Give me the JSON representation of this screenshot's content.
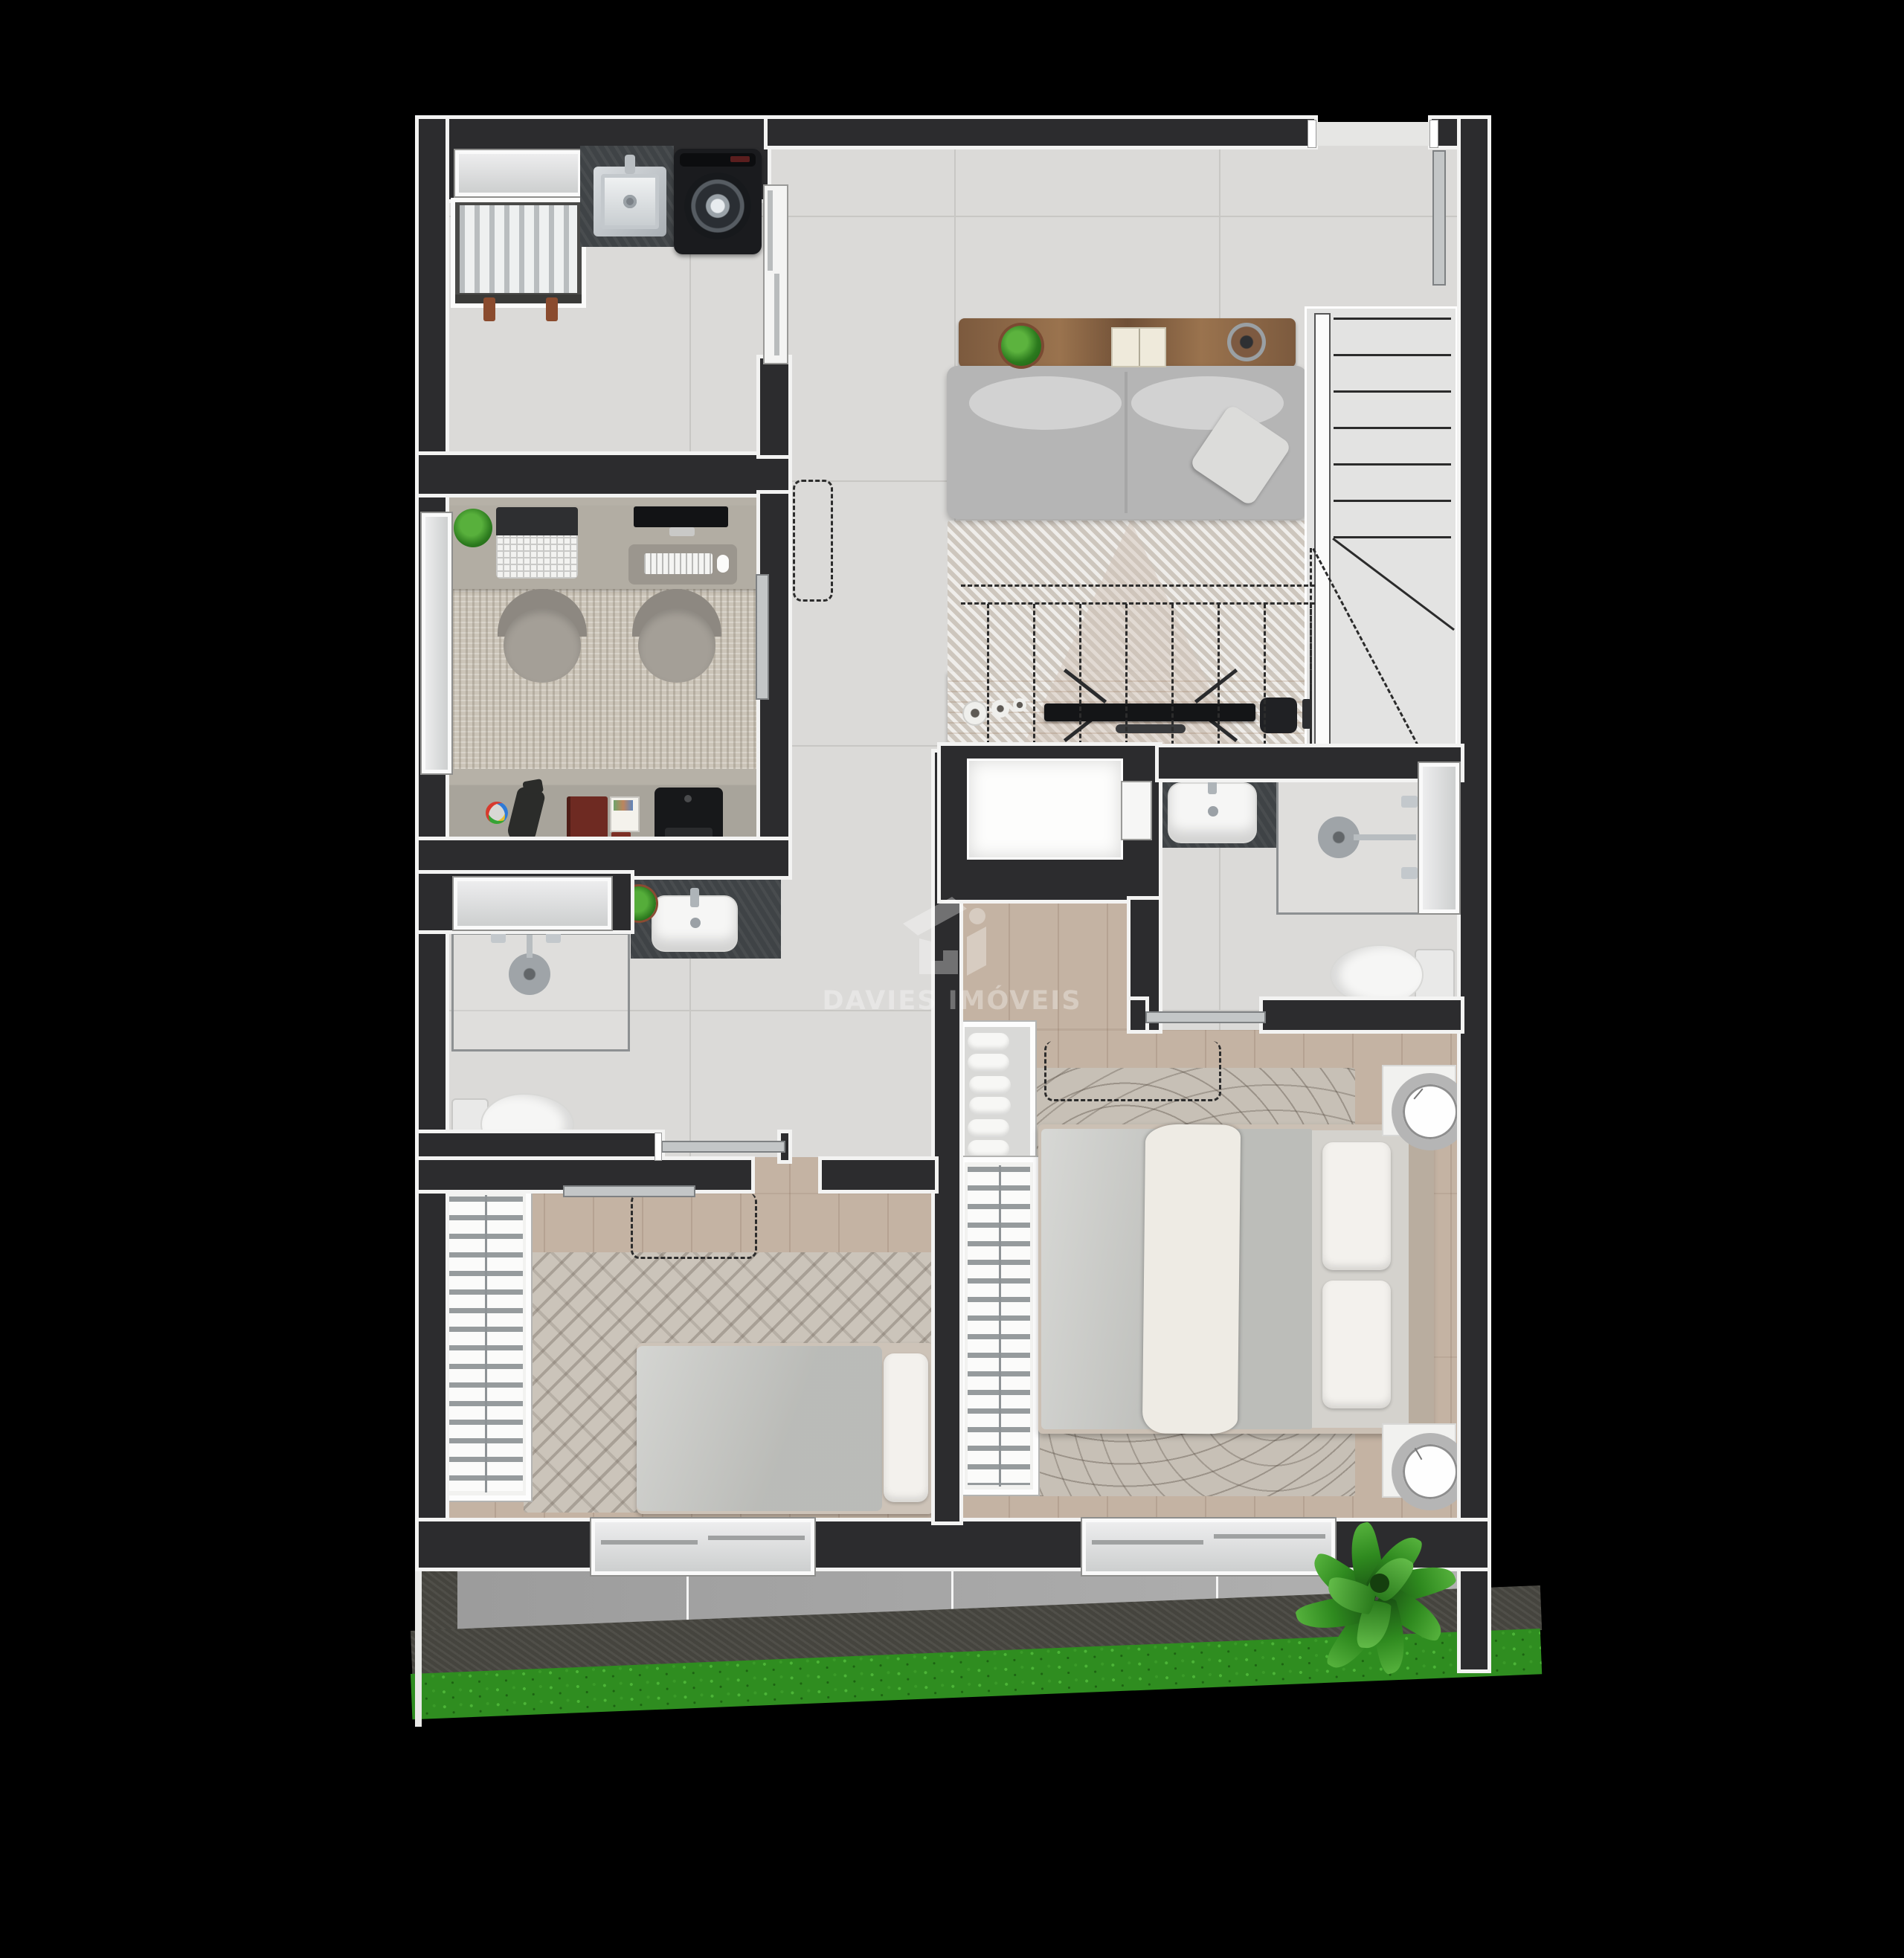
{
  "watermark": {
    "brand": "DAVIES IMÓVEIS",
    "logo": "davies-house-monogram"
  },
  "colors": {
    "bg": "#000000",
    "wall": "#2c2c2e",
    "outline": "#f3f3f2",
    "tile": "#dbdad8",
    "tileLine": "#c8c7c4",
    "wood": "#c4b3a3",
    "office": "#b6b1a7",
    "terrace": "#a8a8a8",
    "grout": "#f5f5f5",
    "slate": "#45443e",
    "hedge": "#2f8d20",
    "counter": "#3f4346",
    "glass": "#8d9092",
    "dash": "#2c2c2c",
    "fixture": "#f6f6f5",
    "consoleWood": "#8a6647",
    "tvWood": "#bf8f66",
    "sofa": "#b5b5b5",
    "cushion": "#d2d2d2",
    "rugLiving": "#d8d2ca",
    "rugOffice": "#ccc5b9",
    "rugWavy": "#c7c0b6",
    "rugChevron": "#cbc4ba",
    "duvet": "#c6c7c3",
    "sheet": "#d4d2cd",
    "pillow": "#f3f1ed",
    "throw": "#eeebe4",
    "headboard": "#b9ad9f",
    "washer": "#1a1b1e",
    "green": "#3f9b2e",
    "greenDark": "#1e5c17",
    "watermark": "rgba(255,255,255,0.33)"
  },
  "plan": {
    "type": "residential-floor-plan-render",
    "rooms": [
      {
        "name": "laundry",
        "items": [
          "frosted-window",
          "condenser-niche",
          "utility-sink",
          "washing-machine",
          "sliding-partition"
        ]
      },
      {
        "name": "living-room",
        "items": [
          "console-table",
          "plant-pot",
          "open-book",
          "table-lamp",
          "sofa",
          "throw-pillow",
          "striped-rug",
          "overhead-cabinet-dashed",
          "tv-stand",
          "tv",
          "media-box",
          "decor-vases",
          "entry-sliding-door"
        ]
      },
      {
        "name": "staircase",
        "items": [
          "handrail",
          "treads",
          "winder-line",
          "direction-dashes"
        ]
      },
      {
        "name": "home-office",
        "items": [
          "desk",
          "desk-plant",
          "laptop",
          "monitor",
          "desk-mat",
          "keyboard",
          "mouse",
          "office-chair",
          "office-chair",
          "woven-rug",
          "credenza",
          "color-palette",
          "desk-lamp",
          "notebook",
          "sketchpad",
          "printer",
          "window",
          "sliding-door",
          "door-marker-dashed"
        ]
      },
      {
        "name": "bathroom-1",
        "items": [
          "frosted-window",
          "vanity-counter",
          "vessel-sink",
          "plant-pot",
          "shower-enclosure",
          "shower-head",
          "shower-controls",
          "toilet",
          "sliding-door"
        ]
      },
      {
        "name": "bathroom-2",
        "items": [
          "vanity-counter",
          "vessel-sink",
          "shower-enclosure",
          "shower-head",
          "shower-controls",
          "toilet",
          "frosted-window",
          "sliding-door"
        ]
      },
      {
        "name": "hallway",
        "items": [
          "service-shaft",
          "shaft-door"
        ]
      },
      {
        "name": "bedroom-1",
        "items": [
          "wardrobe-hangers",
          "single-bed",
          "pillow",
          "chevron-rug",
          "sliding-door",
          "door-swing-dashed",
          "terrace-window"
        ]
      },
      {
        "name": "bedroom-2-master",
        "items": [
          "shoe-rack-slippers",
          "wardrobe-hangers",
          "double-bed",
          "pillows",
          "throw-blanket",
          "nightstand-clock",
          "nightstand-clock",
          "wavy-rug",
          "door-swing-dashed",
          "terrace-sliding-door"
        ]
      },
      {
        "name": "terrace",
        "items": [
          "tile-floor",
          "stone-edge",
          "hedge-strip",
          "tropical-plant"
        ]
      }
    ]
  }
}
